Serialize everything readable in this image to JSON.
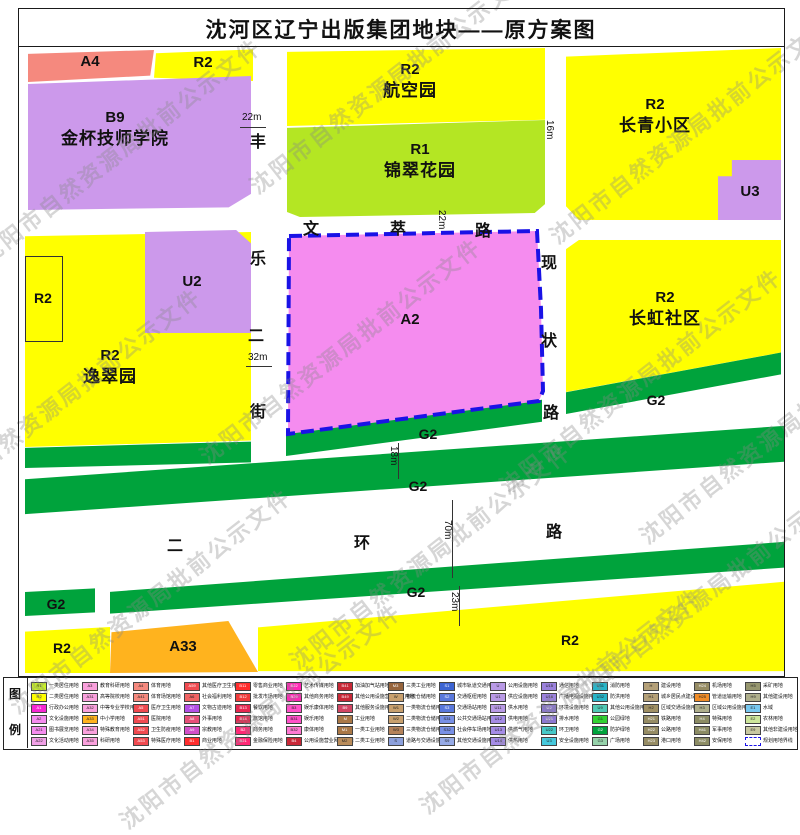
{
  "title": "沈河区辽宁出版集团地块——原方案图",
  "watermark": {
    "text": "沈阳市自然资源局批前公示文件"
  },
  "colors": {
    "yellow": "#FFFF00",
    "ygreen": "#B4E623",
    "purple": "#CC99EB",
    "salmon": "#F5897E",
    "pink": "#F58CEF",
    "green": "#00A33C",
    "orange": "#FFB31E",
    "blue": "#1A12E6"
  },
  "map": {
    "parcels": {
      "a4": {
        "code": "A4"
      },
      "r2_nw": {
        "code": "R2"
      },
      "b9": {
        "code": "B9",
        "name": "金杯技师学院"
      },
      "hangkongyuan": {
        "code": "R2",
        "name": "航空园"
      },
      "jincuihuayuan": {
        "code": "R1",
        "name": "锦翠花园"
      },
      "changqing": {
        "code": "R2",
        "name": "长青小区"
      },
      "u3": {
        "code": "U3"
      },
      "u2": {
        "code": "U2"
      },
      "r2_small": {
        "code": "R2"
      },
      "yicuiyuan": {
        "code": "R2",
        "name": "逸翠园"
      },
      "a2": {
        "code": "A2"
      },
      "changhong": {
        "code": "R2",
        "name": "长虹社区"
      },
      "g2": {
        "code": "G2"
      },
      "r2_bl": {
        "code": "R2"
      },
      "a33": {
        "code": "A33"
      },
      "r2_bottom": {
        "code": "R2"
      }
    }
  },
  "roads": {
    "fengle_er_jie": {
      "name_chars": [
        "丰",
        "乐",
        "二",
        "街"
      ],
      "widths": [
        "22m",
        "32m"
      ]
    },
    "wencui_lu": {
      "name_chars": [
        "文",
        "萃",
        "路"
      ],
      "width": "22m"
    },
    "xianzhuang_lu": {
      "name_chars": [
        "现",
        "状",
        "路"
      ]
    },
    "er_huan_lu": {
      "name_chars": [
        "二",
        "环",
        "路"
      ],
      "width": "70m"
    },
    "east_road_width": "16m",
    "green_belt_width": "18m",
    "south_belt_width": "23m"
  },
  "legend": {
    "header_chars": [
      "图",
      "例"
    ],
    "entries": [
      {
        "c": "R1",
        "t": "一类居住用地",
        "bg": "#C8F028"
      },
      {
        "c": "R2",
        "t": "二类居住用地",
        "bg": "#FFFF00"
      },
      {
        "c": "A1",
        "t": "行政办公用地",
        "bg": "#F628D2"
      },
      {
        "c": "A2",
        "t": "文化设施用地",
        "bg": "#F58CEF"
      },
      {
        "c": "A21",
        "t": "图书展览用地",
        "bg": "#F58CEF"
      },
      {
        "c": "A22",
        "t": "文化活动用地",
        "bg": "#F0A0E6"
      },
      {
        "c": "A3",
        "t": "教育科研用地",
        "bg": "#F9A0DC"
      },
      {
        "c": "A31",
        "t": "高等院校用地",
        "bg": "#F9A0DC"
      },
      {
        "c": "A32",
        "t": "中等专业学校用地",
        "bg": "#F9A0DC"
      },
      {
        "c": "A33",
        "t": "中小学用地",
        "bg": "#FFB31E"
      },
      {
        "c": "A34",
        "t": "特殊教育用地",
        "bg": "#F9A0DC"
      },
      {
        "c": "A35",
        "t": "科研用地",
        "bg": "#F9A0DC"
      },
      {
        "c": "A4",
        "t": "体育用地",
        "bg": "#F5897E"
      },
      {
        "c": "A41",
        "t": "体育场馆用地",
        "bg": "#F5897E"
      },
      {
        "c": "A5",
        "t": "医疗卫生用地",
        "bg": "#F04A50"
      },
      {
        "c": "A51",
        "t": "医院用地",
        "bg": "#F04A50"
      },
      {
        "c": "A52",
        "t": "卫生防疫用地",
        "bg": "#F04A50"
      },
      {
        "c": "A53",
        "t": "特殊医疗用地",
        "bg": "#F04A50"
      },
      {
        "c": "A59",
        "t": "其他医疗卫生用地",
        "bg": "#F04A50"
      },
      {
        "c": "A6",
        "t": "社会福利用地",
        "bg": "#F06464"
      },
      {
        "c": "A7",
        "t": "文物古迹用地",
        "bg": "#B450E6"
      },
      {
        "c": "A8",
        "t": "外事用地",
        "bg": "#E65078"
      },
      {
        "c": "A9",
        "t": "宗教用地",
        "bg": "#D250C8"
      },
      {
        "c": "B1",
        "t": "商业用地",
        "bg": "#FF2D2D"
      },
      {
        "c": "B11",
        "t": "零售商业用地",
        "bg": "#FF2D2D"
      },
      {
        "c": "B12",
        "t": "批发市场用地",
        "bg": "#F03C3C"
      },
      {
        "c": "B13",
        "t": "餐饮用地",
        "bg": "#E62850"
      },
      {
        "c": "B14",
        "t": "旅馆用地",
        "bg": "#E62850"
      },
      {
        "c": "B2",
        "t": "商务用地",
        "bg": "#FF2875"
      },
      {
        "c": "B21",
        "t": "金融保险用地",
        "bg": "#FF2875"
      },
      {
        "c": "B22",
        "t": "艺术传媒用地",
        "bg": "#FF28B4"
      },
      {
        "c": "B29",
        "t": "其他商务用地",
        "bg": "#FF28B4"
      },
      {
        "c": "B3",
        "t": "娱乐康体用地",
        "bg": "#FF50C8"
      },
      {
        "c": "B31",
        "t": "娱乐用地",
        "bg": "#FF50C8"
      },
      {
        "c": "B32",
        "t": "康体用地",
        "bg": "#FF78D2"
      },
      {
        "c": "B4",
        "t": "公用设施营业网点用地",
        "bg": "#C82837"
      },
      {
        "c": "B41",
        "t": "加油加气站用地",
        "bg": "#C82837"
      },
      {
        "c": "B49",
        "t": "其他公用设施营业网点用地",
        "bg": "#C82837"
      },
      {
        "c": "B9",
        "t": "其他服务设施用地",
        "bg": "#D24664"
      },
      {
        "c": "M",
        "t": "工业用地",
        "bg": "#AA7846"
      },
      {
        "c": "M1",
        "t": "一类工业用地",
        "bg": "#AA7846"
      },
      {
        "c": "M2",
        "t": "二类工业用地",
        "bg": "#B98C5A"
      },
      {
        "c": "M3",
        "t": "三类工业用地",
        "bg": "#96643C"
      },
      {
        "c": "W",
        "t": "物流仓储用地",
        "bg": "#C8A06E"
      },
      {
        "c": "W1",
        "t": "一类物流仓储用地",
        "bg": "#C8A06E"
      },
      {
        "c": "W2",
        "t": "二类物流仓储用地",
        "bg": "#C8A06E"
      },
      {
        "c": "W3",
        "t": "三类物流仓储用地",
        "bg": "#B4825A"
      },
      {
        "c": "S",
        "t": "道路与交通设施用地",
        "bg": "#8CA0DC"
      },
      {
        "c": "S1",
        "t": "城市轨道交通用地",
        "bg": "#3C64D2"
      },
      {
        "c": "S2",
        "t": "交通枢纽用地",
        "bg": "#5A78DC"
      },
      {
        "c": "S3",
        "t": "交通场站用地",
        "bg": "#5A78DC"
      },
      {
        "c": "S31",
        "t": "公共交通场站用地",
        "bg": "#7890E6"
      },
      {
        "c": "S32",
        "t": "社会停车场用地",
        "bg": "#7890E6"
      },
      {
        "c": "S9",
        "t": "其他交通设施用地",
        "bg": "#96AAE6"
      },
      {
        "c": "U",
        "t": "公用设施用地",
        "bg": "#B99AE6"
      },
      {
        "c": "U1",
        "t": "供应设施用地",
        "bg": "#B99AE6"
      },
      {
        "c": "U11",
        "t": "供水用地",
        "bg": "#B99AE6"
      },
      {
        "c": "U12",
        "t": "供电用地",
        "bg": "#A58CE6"
      },
      {
        "c": "U13",
        "t": "供燃气用地",
        "bg": "#A58CE6"
      },
      {
        "c": "U14",
        "t": "供热用地",
        "bg": "#A58CE6"
      },
      {
        "c": "U15",
        "t": "通信用地",
        "bg": "#9B82DC"
      },
      {
        "c": "U16",
        "t": "广播电视设施用地",
        "bg": "#9B82DC"
      },
      {
        "c": "U2",
        "t": "环境设施用地",
        "bg": "#8C78D2"
      },
      {
        "c": "U21",
        "t": "排水用地",
        "bg": "#8C78D2"
      },
      {
        "c": "U22",
        "t": "环卫用地",
        "bg": "#46C8C8"
      },
      {
        "c": "U3",
        "t": "安全设施用地",
        "bg": "#46C8DC"
      },
      {
        "c": "U31",
        "t": "消防用地",
        "bg": "#28B4C8"
      },
      {
        "c": "U32",
        "t": "防洪用地",
        "bg": "#28B4C8"
      },
      {
        "c": "U9",
        "t": "其他公用设施用地",
        "bg": "#50C8B4"
      },
      {
        "c": "G1",
        "t": "公园绿地",
        "bg": "#32D232"
      },
      {
        "c": "G2",
        "t": "防护绿地",
        "bg": "#00A33C"
      },
      {
        "c": "G3",
        "t": "广场用地",
        "bg": "#96D2AA"
      },
      {
        "c": "H",
        "t": "建设用地",
        "bg": "#B4A078"
      },
      {
        "c": "H1",
        "t": "城乡居民点建设用地",
        "bg": "#B4A078"
      },
      {
        "c": "H2",
        "t": "区域交通设施用地",
        "bg": "#A09064"
      },
      {
        "c": "H21",
        "t": "铁路用地",
        "bg": "#968C64"
      },
      {
        "c": "H22",
        "t": "公路用地",
        "bg": "#968C64"
      },
      {
        "c": "H23",
        "t": "港口用地",
        "bg": "#968C64"
      },
      {
        "c": "H24",
        "t": "机场用地",
        "bg": "#968C64"
      },
      {
        "c": "H25",
        "t": "管道运输用地",
        "bg": "#F08C28"
      },
      {
        "c": "H3",
        "t": "区域公用设施用地",
        "bg": "#AFAF8C"
      },
      {
        "c": "H4",
        "t": "特殊用地",
        "bg": "#8C8C64"
      },
      {
        "c": "H41",
        "t": "军事用地",
        "bg": "#8C8C64"
      },
      {
        "c": "H42",
        "t": "安保用地",
        "bg": "#8C8C64"
      },
      {
        "c": "H5",
        "t": "采矿用地",
        "bg": "#96966E"
      },
      {
        "c": "H9",
        "t": "其他建设用地",
        "bg": "#AFAF8C"
      },
      {
        "c": "E1",
        "t": "水域",
        "bg": "#78C8F0"
      },
      {
        "c": "E2",
        "t": "农林用地",
        "bg": "#CDE69B"
      },
      {
        "c": "E9",
        "t": "其他非建设用地",
        "bg": "#C8C8A0"
      },
      {
        "c": "",
        "t": "规划用地界线",
        "bg": "dashed"
      }
    ]
  }
}
